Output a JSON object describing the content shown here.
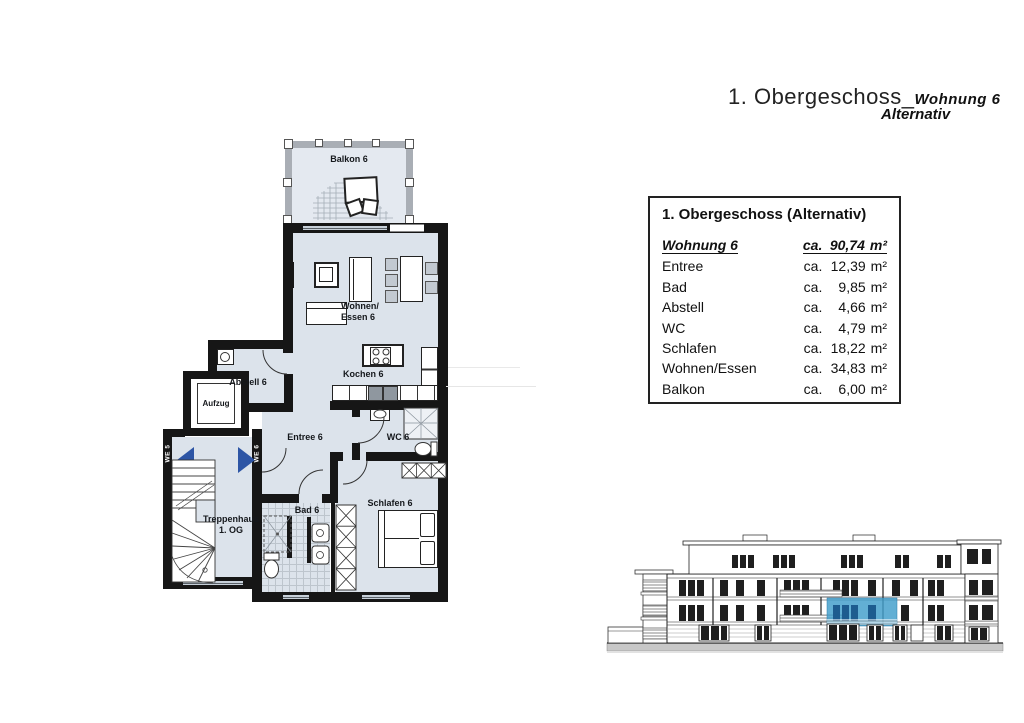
{
  "page_title": {
    "main": "1. Obergeschoss_",
    "sub1": "Wohnung 6",
    "sub2": "Alternativ"
  },
  "area_table": {
    "title": "1. Obergeschoss (Alternativ)",
    "header": {
      "label": "Wohnung 6",
      "prefix": "ca.",
      "amount": "90,74",
      "unit": "m²"
    },
    "rows": [
      {
        "label": "Entree",
        "prefix": "ca.",
        "amount": "12,39",
        "unit": "m²"
      },
      {
        "label": "Bad",
        "prefix": "ca.",
        "amount": "9,85",
        "unit": "m²"
      },
      {
        "label": "Abstell",
        "prefix": "ca.",
        "amount": "4,66",
        "unit": "m²"
      },
      {
        "label": "WC",
        "prefix": "ca.",
        "amount": "4,79",
        "unit": "m²"
      },
      {
        "label": "Schlafen",
        "prefix": "ca.",
        "amount": "18,22",
        "unit": "m²"
      },
      {
        "label": "Wohnen/Essen",
        "prefix": "ca.",
        "amount": "34,83",
        "unit": "m²"
      },
      {
        "label": "Balkon",
        "prefix": "ca.",
        "amount": "6,00",
        "unit": "m²"
      }
    ]
  },
  "floor_plan": {
    "labels": {
      "balkon": "Balkon 6",
      "wohnen_line1": "Wohnen/",
      "wohnen_line2": "Essen 6",
      "kochen": "Kochen 6",
      "abstell": "Abstell 6",
      "aufzug": "Aufzug",
      "entree": "Entree 6",
      "wc": "WC 6",
      "schlafen": "Schlafen 6",
      "bad": "Bad 6",
      "treppenhaus_line1": "Treppenhaus",
      "treppenhaus_line2": "1. OG",
      "we5": "WE 5",
      "we6": "WE 6"
    },
    "colors": {
      "wall": "#161616",
      "room_fill": "#dce3eb",
      "balcony_fill": "#e4e9f0",
      "window_band": "#c7d0d9",
      "entry_arrow": "#2d55a5"
    }
  },
  "elevation": {
    "highlight_color": "#3f9dcb",
    "highlight_window_color": "#1d5c8f"
  }
}
